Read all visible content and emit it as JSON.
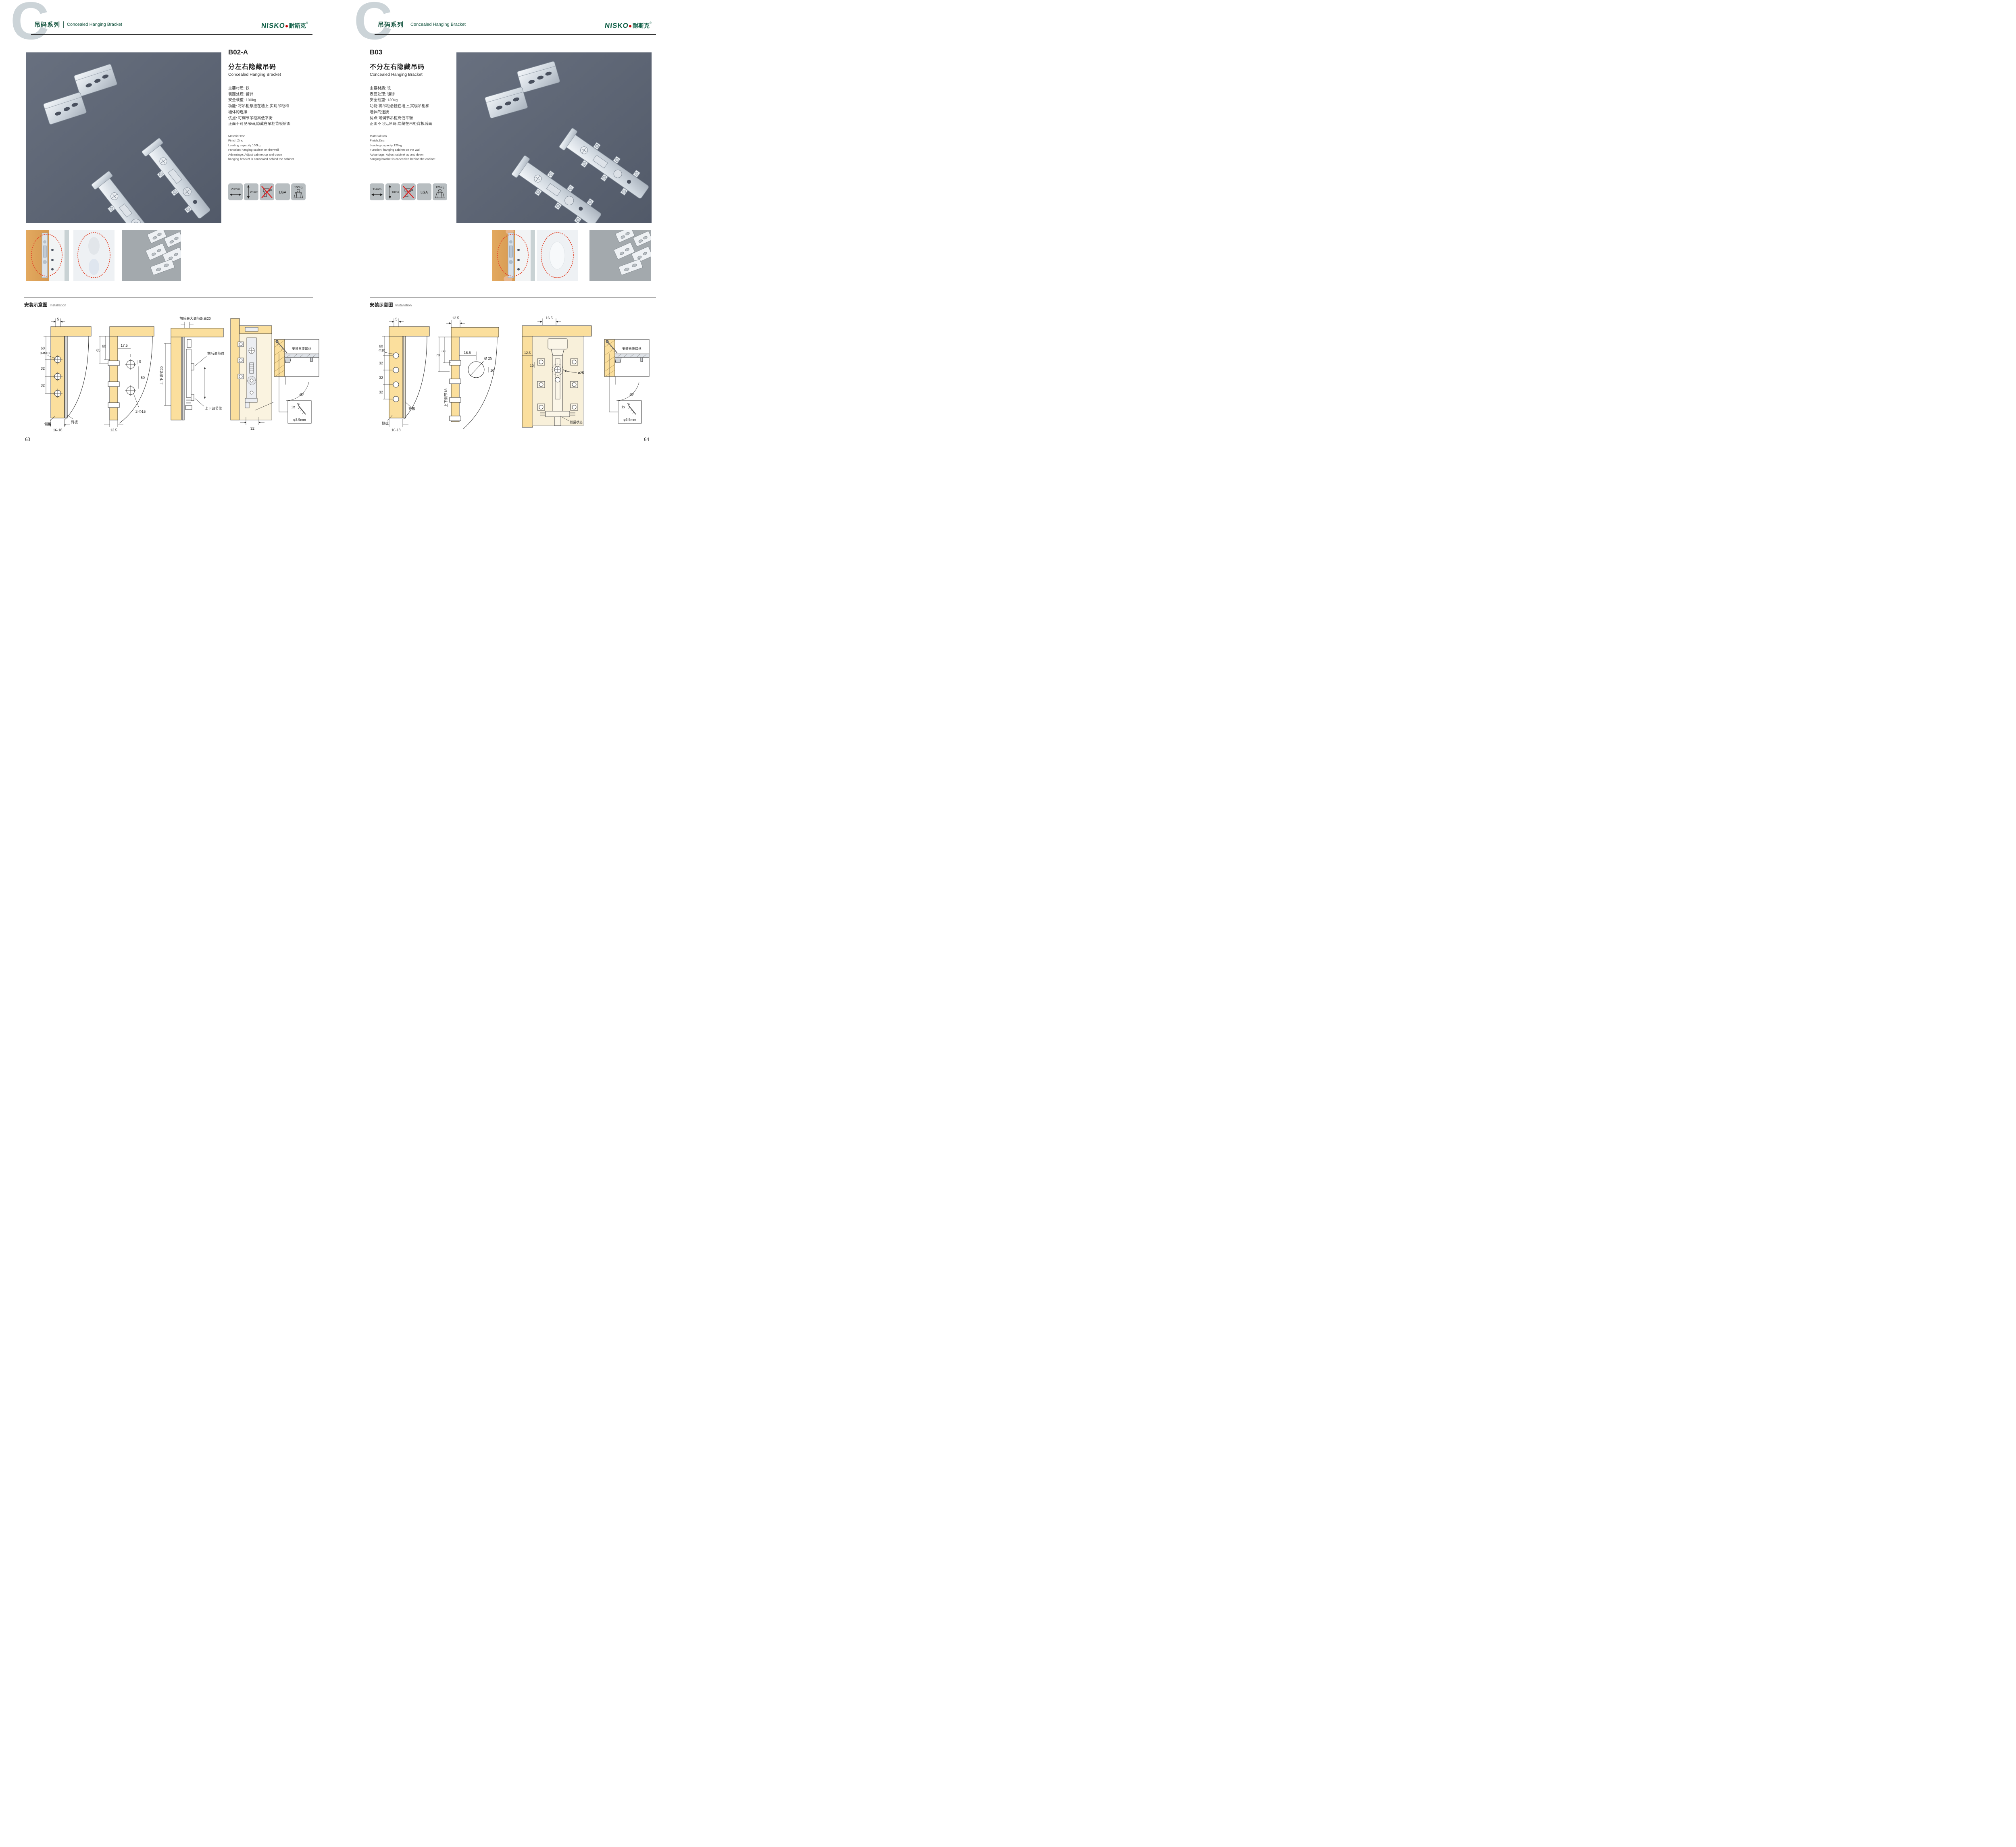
{
  "header": {
    "watermark": "C",
    "series_zh": "吊码系列",
    "series_en": "Concealed Hanging Bracket",
    "brand": {
      "latin": "NISKO",
      "zh": "耐斯克",
      "reg": "®"
    }
  },
  "installation_heading": {
    "zh": "安装示意图",
    "en": "Installation"
  },
  "pages": [
    {
      "code": "B02-A",
      "title_zh": "分左右隐藏吊码",
      "title_en": "Concealed Hanging Bracket",
      "specs_zh": [
        "主要材质: 铁",
        "表面处理: 镀锌",
        "安全载重: 100kg",
        "功能: 将吊柜悬挂在墙上,实现吊柜和",
        "墙体的连接",
        "优点: 可调节吊柜高低平衡",
        "正面不可见吊码,隐藏在吊柜背板后面"
      ],
      "specs_en": [
        "Material:Iron",
        "Finish:Zinc",
        "Loading capacity:100kg",
        "Function: hanging cabinet on the wall",
        "Advantage: Adjust cabinet up and down",
        "hanging bracket is concealed behind the cabinet"
      ],
      "icons": {
        "width": "20mm",
        "height": "20mm",
        "no_drill_icon": "no-drill",
        "cert": "LGA",
        "weight": "100kg"
      },
      "page_number": "63",
      "diagrams": {
        "d1": {
          "top": "5",
          "v1": "60",
          "hole": "3-Φ10",
          "v2": "32",
          "v3": "32",
          "side": "侧板",
          "back": "背板",
          "bottom": "16-18"
        },
        "d2": {
          "h1": "17.5",
          "v1": "65",
          "v2": "60",
          "small": "5",
          "v3": "50",
          "hole": "2-Φ15",
          "bottom": "12.5"
        },
        "d3": {
          "top": "前后最大调节距离20",
          "side": "上下调节20",
          "a": "前后调节位",
          "b": "上下调节位"
        },
        "d4": {
          "bottom": "32"
        },
        "inset": {
          "title": "安装自攻螺丝",
          "angle": "45°",
          "qty": "1x",
          "dia": "φ3.5mm"
        }
      }
    },
    {
      "code": "B03",
      "title_zh": "不分左右隐藏吊码",
      "title_en": "Concealed Hanging Bracket",
      "specs_zh": [
        "主要材质: 铁",
        "表面处理: 镀锌",
        "安全载重: 120kg",
        "功能:将吊柜悬挂在墙上,实现吊柜和",
        "墙体的连接",
        "优点:可调节吊柜高低平衡",
        "正面不可见吊码,隐藏在吊柜背板后面"
      ],
      "specs_en": [
        "Material:Iron",
        "Finish:Zinc",
        "Loading capacity:120kg",
        "Function: hanging cabinet on the wall",
        "Advantage: Adjust cabinet up and down",
        "hanging bracket is concealed behind the cabinet"
      ],
      "icons": {
        "width": "15mm",
        "height": "18mm",
        "no_drill_icon": "no-drill",
        "cert": "LGA",
        "weight": "120Kg"
      },
      "page_number": "64",
      "diagrams": {
        "d1": {
          "top": "5",
          "v1": "60",
          "hole": "Φ10",
          "v2": "32",
          "v3": "32",
          "v4": "32",
          "back": "背板",
          "side": "侧板",
          "bottom": "16-18"
        },
        "d2": {
          "top": "12.5",
          "v1": "70",
          "v2": "60",
          "h1": "16.5",
          "hole": "Ø 25",
          "small": "10",
          "side": "上下调节18"
        },
        "d3": {
          "top": "16.5",
          "h1": "12.5",
          "small": "10",
          "hole": "ø25",
          "state": "锁紧状态"
        },
        "inset": {
          "title": "安装自攻螺丝",
          "angle": "45°",
          "qty": "1x",
          "dia": "φ3.5mm"
        }
      }
    }
  ]
}
